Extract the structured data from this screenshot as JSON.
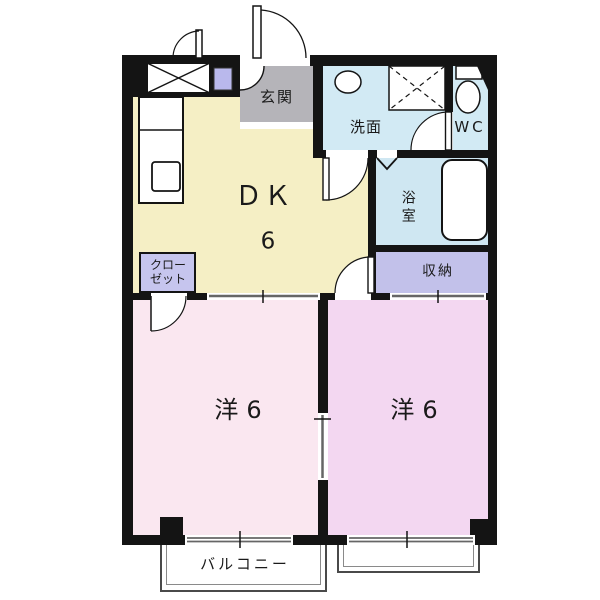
{
  "plan": {
    "title": "2DK apartment floor plan",
    "rooms": {
      "dk_label": "ＤＫ",
      "dk_size": "6",
      "genkan": "玄関",
      "washroom": "洗面",
      "wc": "WC",
      "bathroom": "浴室",
      "storage": "収納",
      "closet_line1": "クロー",
      "closet_line2": "ゼット",
      "western_room_left": "洋6",
      "western_room_right": "洋6",
      "balcony": "バルコニー"
    },
    "colors": {
      "wall": "#141414",
      "dk_floor": "#f5efc5",
      "entry_gray": "#b5b4b9",
      "wet_area_blue": "#d2eaf4",
      "bath_blue": "#cfe7f2",
      "storage_lavender": "#c2c1ea",
      "closet_lavender": "#c6c5ee",
      "room_left_pink": "#fae7f0",
      "room_right_pink": "#f3d7f1",
      "slider_gray": "#666666"
    }
  }
}
